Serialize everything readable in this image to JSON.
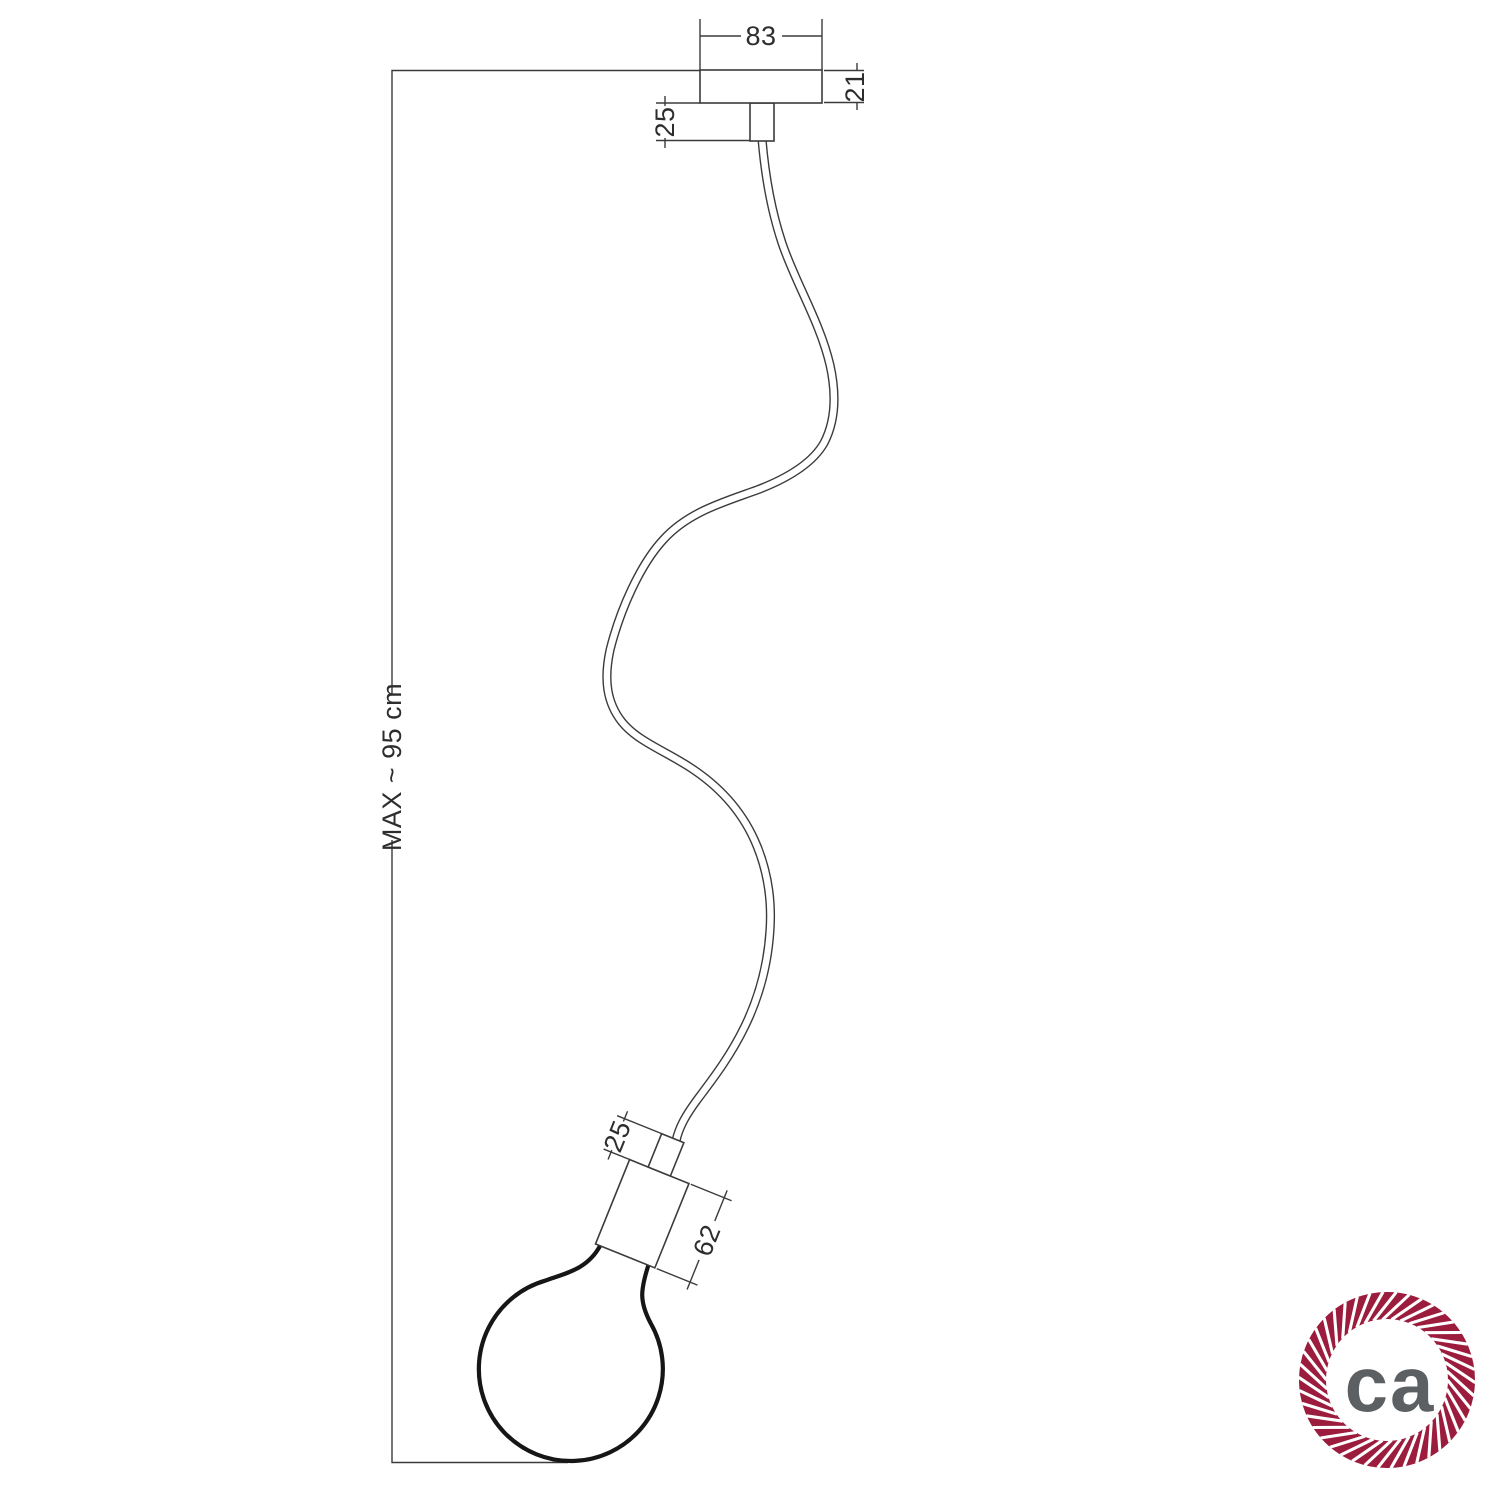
{
  "drawing": {
    "type": "pendant-lamp-technical-drawing",
    "colors": {
      "line": "#3b3b3b",
      "text": "#2d2d2d",
      "bulb": "#161616"
    },
    "dimensions": {
      "canopy_width": "83",
      "canopy_height": "21",
      "top_strain_relief": "25",
      "max_length": "MAX ~ 95 cm",
      "holder_strain_relief": "25",
      "holder_length": "62"
    }
  },
  "logo": {
    "text": "ca",
    "ring_color": "#9b1c3c",
    "text_color": "#5d6063"
  }
}
